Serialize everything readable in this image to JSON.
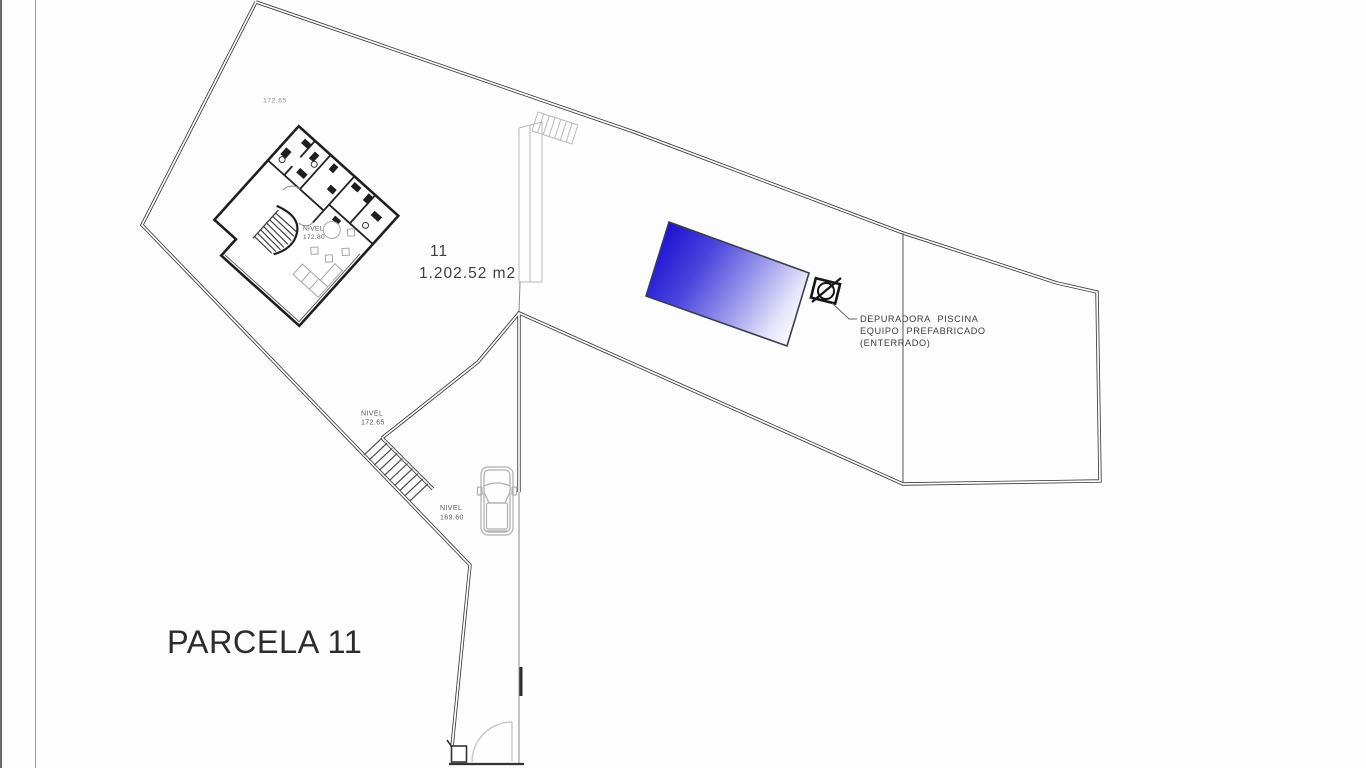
{
  "drawing": {
    "parcel_title": "PARCELA 11",
    "parcel_number": "11",
    "parcel_area": "1.202.52 m2",
    "elevation_marker": "172.65",
    "levels": {
      "house": {
        "label": "NIVEL",
        "value": "172.80"
      },
      "terrace": {
        "label": "NIVEL",
        "value": "172.65"
      },
      "driveway": {
        "label": "NIVEL",
        "value": "169.60"
      }
    },
    "pool_note": {
      "line1": "DEPURADORA PISCINA",
      "line2": "EQUIPO PREFABRICADO",
      "line3": "(ENTERRADO)"
    },
    "colors": {
      "pool_gradient_start": "#1a10cf",
      "pool_gradient_mid": "#9c9aec",
      "pool_gradient_end": "#fdfdff",
      "boundary_line": "#3b3b3b",
      "light_line": "#b9b9b9",
      "text": "#3e3e3e",
      "background": "#fdfdfd"
    }
  }
}
